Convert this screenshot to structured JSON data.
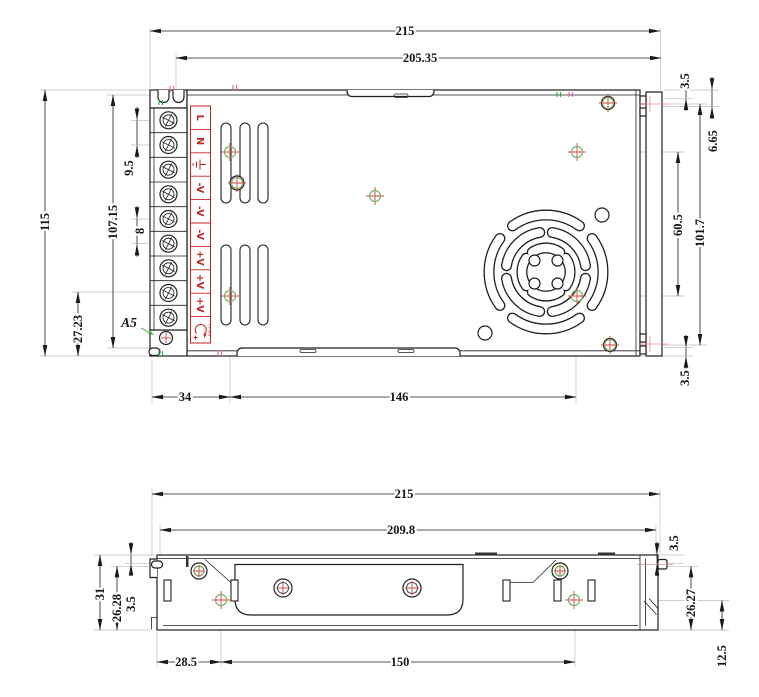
{
  "drawing_type": "power-supply-enclosure-outline-drawing",
  "colors": {
    "outline": "#1f1f1f",
    "terminal_red": "#c32222",
    "marker_red": "#cc4444",
    "marker_green": "#86a86a",
    "tick_pink": "#e060a0",
    "tick_green": "#3aa23a",
    "extension_gray": "#bbbbbb"
  },
  "icons": {
    "terminal_screws": "phillips-screw-icon",
    "ground_terminal": "earth-ground-icon",
    "voltage_adjust": "voltage-adjust-icon",
    "fan": "fan-grille",
    "hole_markers": "position-crosshair-icon"
  },
  "top_view": {
    "dims": {
      "overall_width": "215",
      "mount_width": "205.35",
      "overall_height": "115",
      "mount_height": "107.15",
      "input_terminal_pitch": "9.5",
      "output_terminal_pitch": "8",
      "ground_hole_offset": "27.23",
      "right_notch_top": "3.5",
      "top_hole_offset": "6.65",
      "fan_hole_span": "60.5",
      "side_hole_span": "101.7",
      "right_notch_bottom": "3.5",
      "bottom_offset": "34",
      "bottom_hole_span": "146"
    },
    "callout": "A5",
    "terminals": [
      "L",
      "N",
      "⏚",
      "-V",
      "-V",
      "-V",
      "+V",
      "+V",
      "+V"
    ],
    "adjust_label": "+V ADJ"
  },
  "side_view": {
    "dims": {
      "overall_width": "215",
      "mount_width": "209.8",
      "overall_height": "31",
      "left_height": "26.28",
      "left_notch": "3.5",
      "right_notch": "3.5",
      "right_height": "26.27",
      "right_offset": "12.5",
      "bottom_offset": "28.5",
      "bottom_hole_span": "150"
    }
  }
}
